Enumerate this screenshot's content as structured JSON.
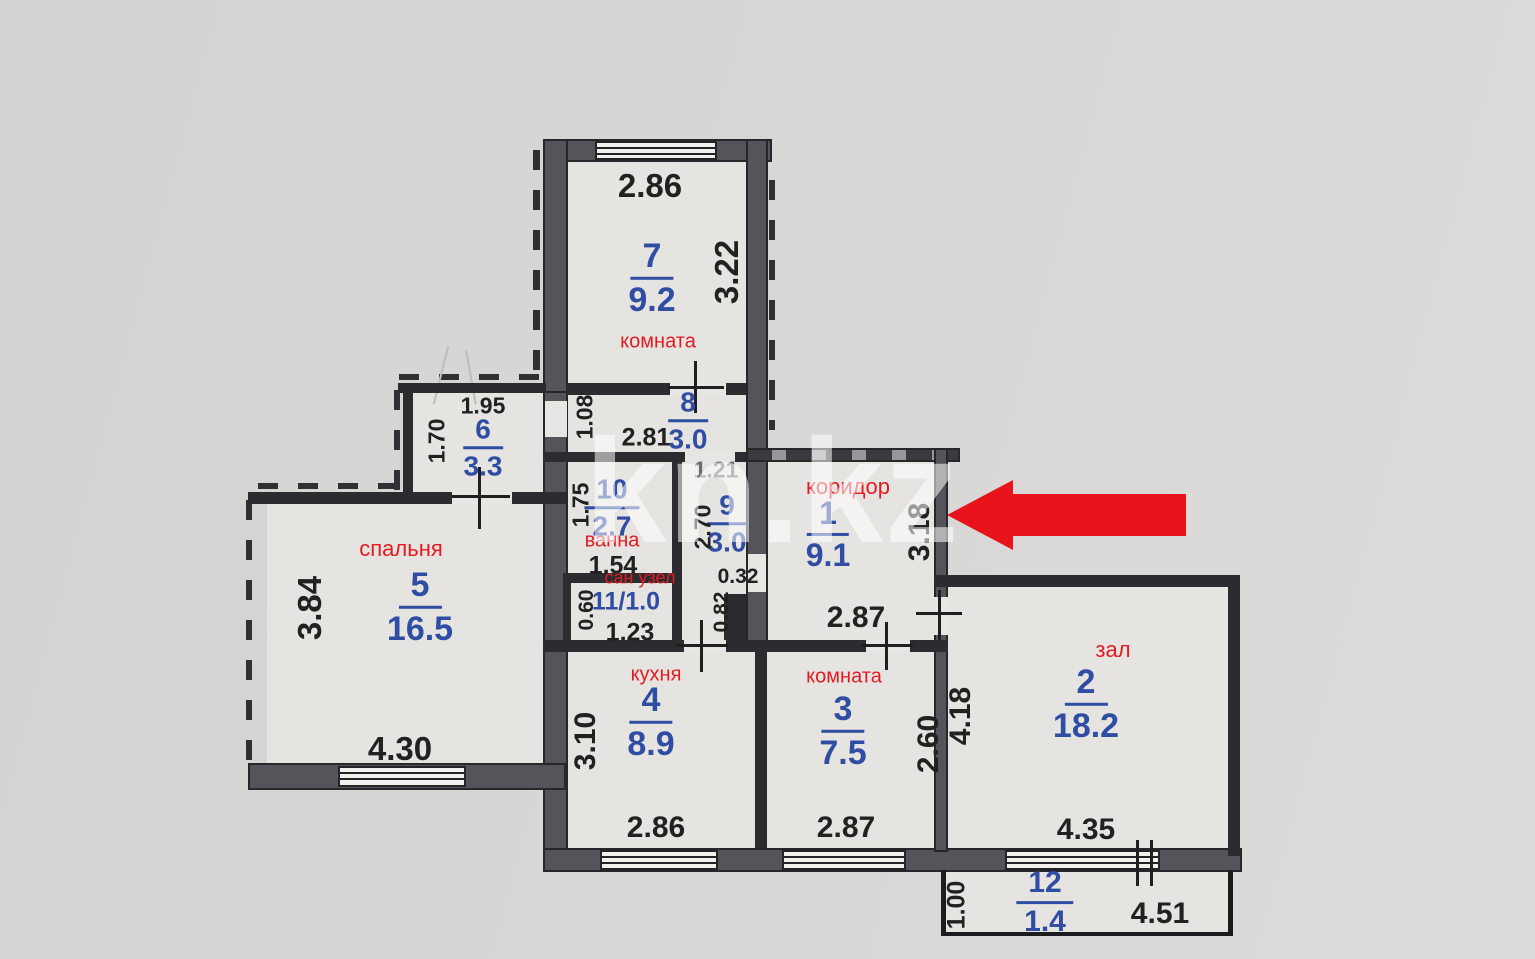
{
  "watermark": "kn.kz",
  "colors": {
    "paper": "#d8d6d4",
    "room_fill": "#e6e4e0",
    "wall_gray": "#54555b",
    "room_number_blue": "#2e4da3",
    "room_label_red": "#e41b22",
    "dimension_black": "#212121",
    "arrow_red": "#e8131b"
  },
  "rooms": [
    {
      "number": "7",
      "area": "9.2",
      "label": "комната"
    },
    {
      "number": "6",
      "area": "3.3"
    },
    {
      "number": "8",
      "area": "3.0"
    },
    {
      "number": "10",
      "area": "2.7",
      "label": "ванна"
    },
    {
      "number": "9",
      "area": "3.0"
    },
    {
      "number": "1",
      "area": "9.1",
      "label": "коридор"
    },
    {
      "number": "11",
      "area": "1.0",
      "label": "сан узел",
      "display": "11/1.0"
    },
    {
      "number": "5",
      "area": "16.5",
      "label": "спальня"
    },
    {
      "number": "4",
      "area": "8.9",
      "label": "кухня"
    },
    {
      "number": "3",
      "area": "7.5",
      "label": "комната"
    },
    {
      "number": "2",
      "area": "18.2",
      "label": "зал"
    },
    {
      "number": "12",
      "area": "1.4"
    }
  ],
  "dims": {
    "d7_top": "2.86",
    "d7_right": "3.22",
    "d6_top": "1.95",
    "d6_left": "1.70",
    "d8_w": "2.81",
    "d8_left": "1.08",
    "d9_top": "1.21",
    "d9_left": "2.70",
    "d9_mid": "0.32",
    "d9_low": "0.82",
    "d10_left": "1.75",
    "d10_bottom": "1.54",
    "d11_left": "0.60",
    "d11_bottom": "1.23",
    "d1_right": "3.18",
    "d1_bottom": "2.87",
    "d5_left": "3.84",
    "d5_bottom": "4.30",
    "d4_left": "3.10",
    "d4_bottom": "2.86",
    "d3_right": "2.60",
    "d3_bottom": "2.87",
    "d2_left": "4.18",
    "d2_bottom": "4.35",
    "d12_left": "1.00",
    "d12_bottom": "4.51"
  },
  "annotation": {
    "type": "arrow",
    "color": "#e8131b",
    "points_at": "коридор right wall"
  }
}
